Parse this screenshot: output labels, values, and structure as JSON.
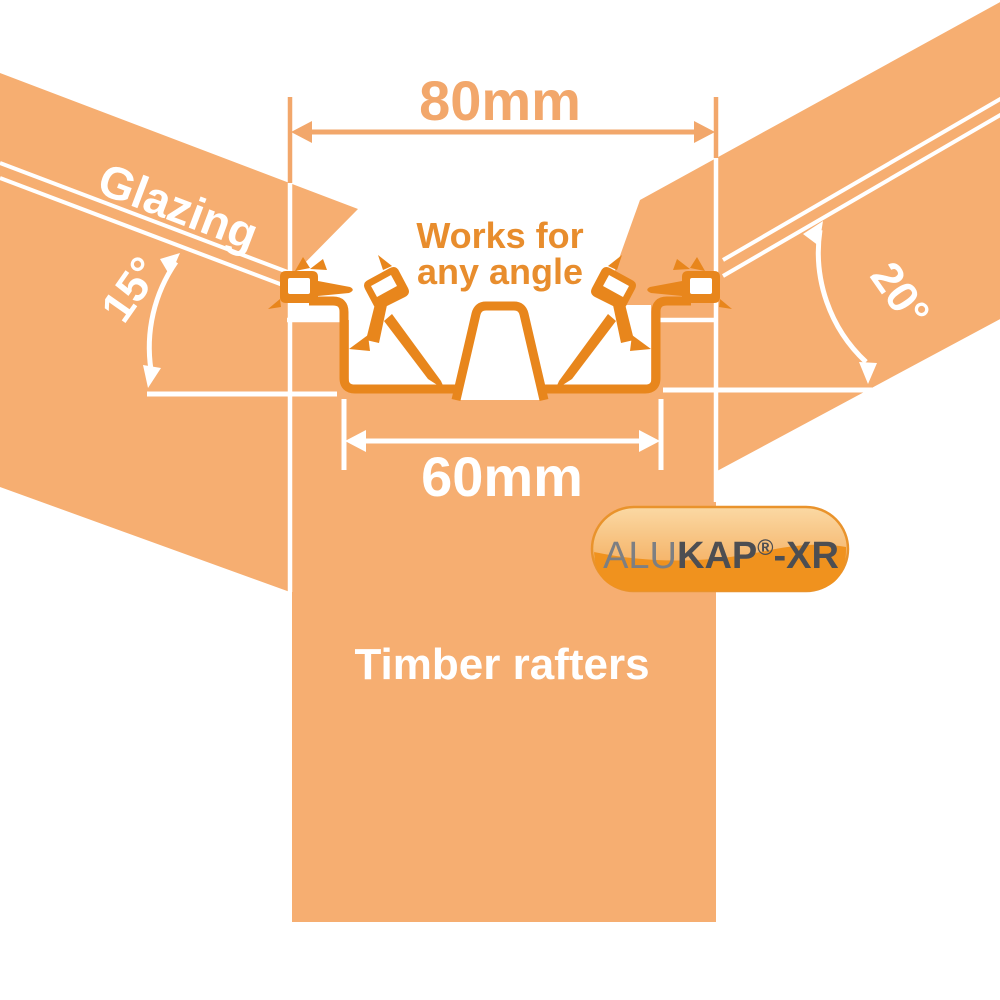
{
  "illustration": {
    "labels": {
      "glazing": "Glazing",
      "works_for_line1": "Works for",
      "works_for_line2": "any angle",
      "timber_rafters": "Timber rafters"
    },
    "dimensions": {
      "top_width": "80mm",
      "base_width": "60mm",
      "left_angle": "15°",
      "right_angle": "20°"
    },
    "badge": {
      "alu": "ALU",
      "kap": "KAP",
      "registered": "®",
      "xr": "-XR"
    },
    "colors": {
      "band_orange": "#F6AE71",
      "profile_orange": "#E8861C",
      "dimension_orange": "#F2A76B",
      "accent_text_orange": "#E88D2D",
      "badge_dark_orange": "#F0921E",
      "badge_text_gray": "#4D4E52",
      "white": "#FFFFFF"
    }
  }
}
